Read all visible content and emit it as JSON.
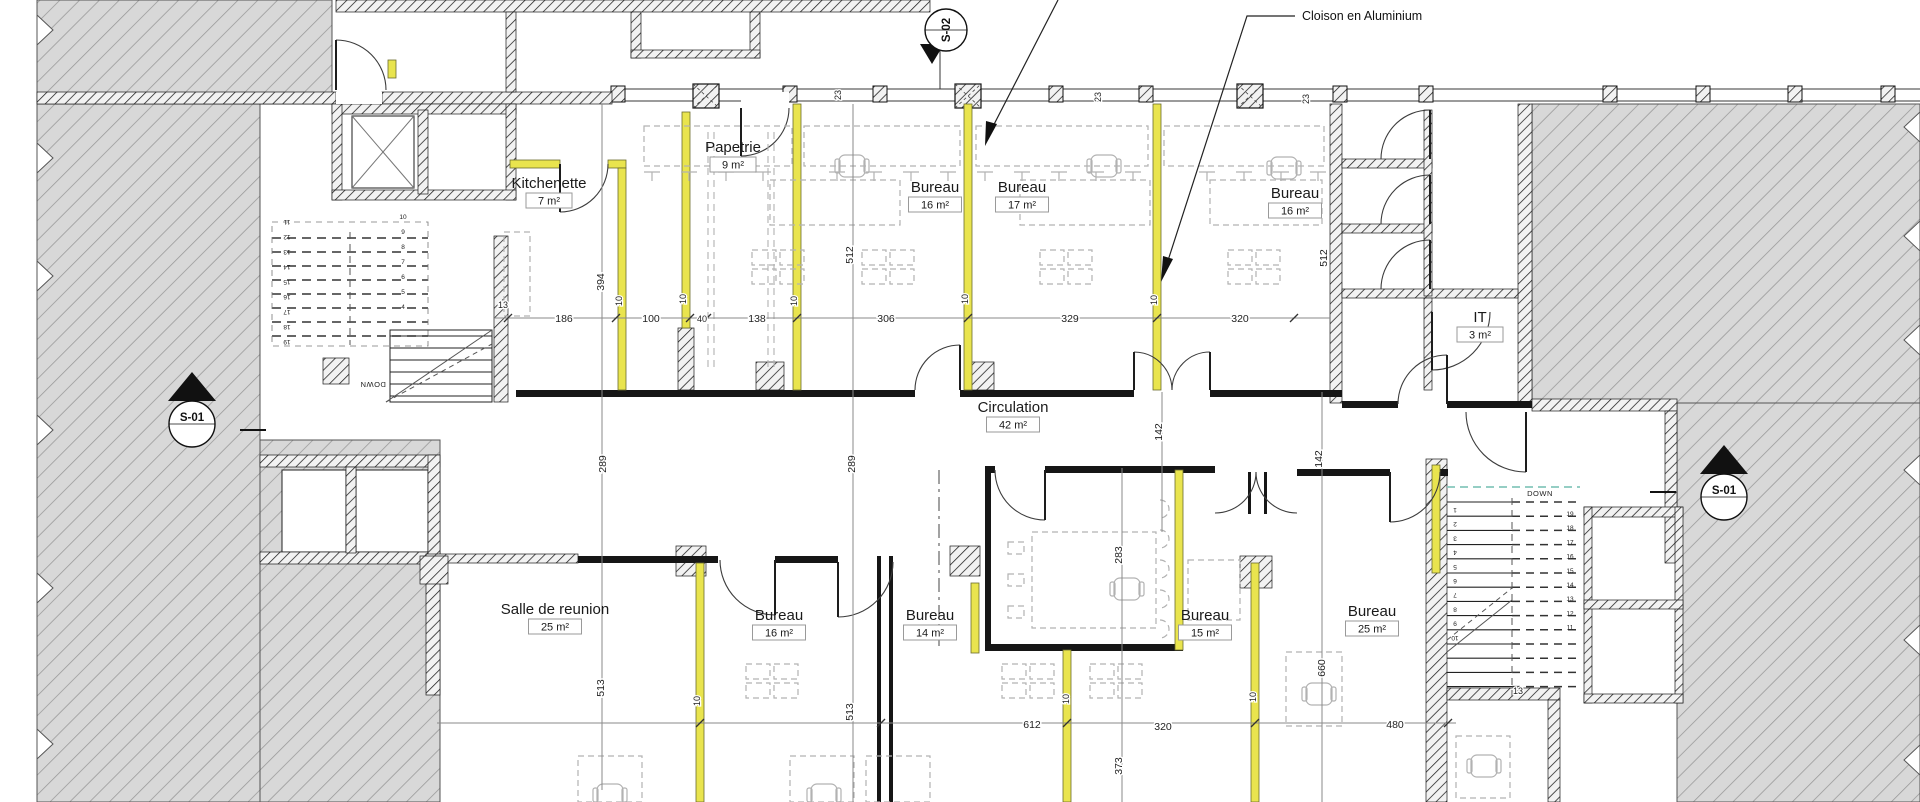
{
  "annotation": {
    "label": "Cloison en Aluminium"
  },
  "markers": {
    "section_top": "S-02",
    "section_left": "S-01",
    "section_right": "S-01"
  },
  "stairs": {
    "down_label": "DOWN",
    "left_inner_numbers": [
      "10",
      "9",
      "8",
      "7",
      "6",
      "5",
      "4"
    ],
    "left_outer_numbers": [
      "11",
      "12",
      "13",
      "14",
      "15",
      "16",
      "17",
      "18",
      "19"
    ],
    "right_inner_numbers": [
      "1",
      "2",
      "3",
      "4",
      "5",
      "6",
      "7",
      "8",
      "9",
      "10"
    ],
    "right_outer_numbers": [
      "19",
      "18",
      "17",
      "16",
      "15",
      "14",
      "13",
      "12",
      "11"
    ]
  },
  "rooms": [
    {
      "name": "Papetrie",
      "area": "9 m²",
      "x": 733,
      "y": 152
    },
    {
      "name": "Kitchenette",
      "area": "7 m²",
      "x": 549,
      "y": 188
    },
    {
      "name": "Bureau",
      "area": "16 m²",
      "x": 935,
      "y": 192
    },
    {
      "name": "Bureau",
      "area": "17 m²",
      "x": 1022,
      "y": 192
    },
    {
      "name": "Bureau",
      "area": "16 m²",
      "x": 1295,
      "y": 198
    },
    {
      "name": "IT",
      "area": "3 m²",
      "x": 1480,
      "y": 322
    },
    {
      "name": "Circulation",
      "area": "42 m²",
      "x": 1013,
      "y": 412
    },
    {
      "name": "Salle de reunion",
      "area": "25 m²",
      "x": 555,
      "y": 614
    },
    {
      "name": "Bureau",
      "area": "16 m²",
      "x": 779,
      "y": 620
    },
    {
      "name": "Bureau",
      "area": "14 m²",
      "x": 930,
      "y": 620
    },
    {
      "name": "Bureau",
      "area": "15 m²",
      "x": 1205,
      "y": 620
    },
    {
      "name": "Bureau",
      "area": "25 m²",
      "x": 1372,
      "y": 616
    }
  ],
  "dimensions": [
    {
      "v": "13",
      "x": 503,
      "y": 308,
      "r": 0
    },
    {
      "v": "186",
      "x": 564,
      "y": 322,
      "r": 0
    },
    {
      "v": "100",
      "x": 651,
      "y": 322,
      "r": 0
    },
    {
      "v": "40",
      "x": 702,
      "y": 322,
      "r": 0
    },
    {
      "v": "138",
      "x": 757,
      "y": 322,
      "r": 0
    },
    {
      "v": "306",
      "x": 886,
      "y": 322,
      "r": 0
    },
    {
      "v": "329",
      "x": 1070,
      "y": 322,
      "r": 0
    },
    {
      "v": "320",
      "x": 1240,
      "y": 322,
      "r": 0
    },
    {
      "v": "10",
      "x": 622,
      "y": 301,
      "r": 90
    },
    {
      "v": "10",
      "x": 686,
      "y": 299,
      "r": 90
    },
    {
      "v": "10",
      "x": 797,
      "y": 301,
      "r": 90
    },
    {
      "v": "10",
      "x": 968,
      "y": 299,
      "r": 90
    },
    {
      "v": "10",
      "x": 1157,
      "y": 300,
      "r": 90
    },
    {
      "v": "23",
      "x": 841,
      "y": 95,
      "r": 90
    },
    {
      "v": "23",
      "x": 1101,
      "y": 97,
      "r": 90
    },
    {
      "v": "23",
      "x": 1309,
      "y": 99,
      "r": 90
    },
    {
      "v": "394",
      "x": 604,
      "y": 282,
      "r": 90
    },
    {
      "v": "512",
      "x": 853,
      "y": 255,
      "r": 90
    },
    {
      "v": "512",
      "x": 1327,
      "y": 258,
      "r": 90
    },
    {
      "v": "289",
      "x": 606,
      "y": 464,
      "r": 90
    },
    {
      "v": "289",
      "x": 855,
      "y": 464,
      "r": 90
    },
    {
      "v": "142",
      "x": 1162,
      "y": 432,
      "r": 90
    },
    {
      "v": "142",
      "x": 1322,
      "y": 459,
      "r": 90
    },
    {
      "v": "283",
      "x": 1122,
      "y": 555,
      "r": 90
    },
    {
      "v": "660",
      "x": 1325,
      "y": 668,
      "r": 90
    },
    {
      "v": "513",
      "x": 604,
      "y": 688,
      "r": 90
    },
    {
      "v": "513",
      "x": 853,
      "y": 712,
      "r": 90
    },
    {
      "v": "373",
      "x": 1122,
      "y": 766,
      "r": 90
    },
    {
      "v": "612",
      "x": 1032,
      "y": 728,
      "r": 0
    },
    {
      "v": "320",
      "x": 1163,
      "y": 730,
      "r": 0
    },
    {
      "v": "480",
      "x": 1395,
      "y": 728,
      "r": 0
    },
    {
      "v": "10",
      "x": 700,
      "y": 701,
      "r": 90
    },
    {
      "v": "10",
      "x": 1069,
      "y": 699,
      "r": 90
    },
    {
      "v": "10",
      "x": 1256,
      "y": 697,
      "r": 90
    },
    {
      "v": "13",
      "x": 1518,
      "y": 694,
      "r": 0
    }
  ]
}
